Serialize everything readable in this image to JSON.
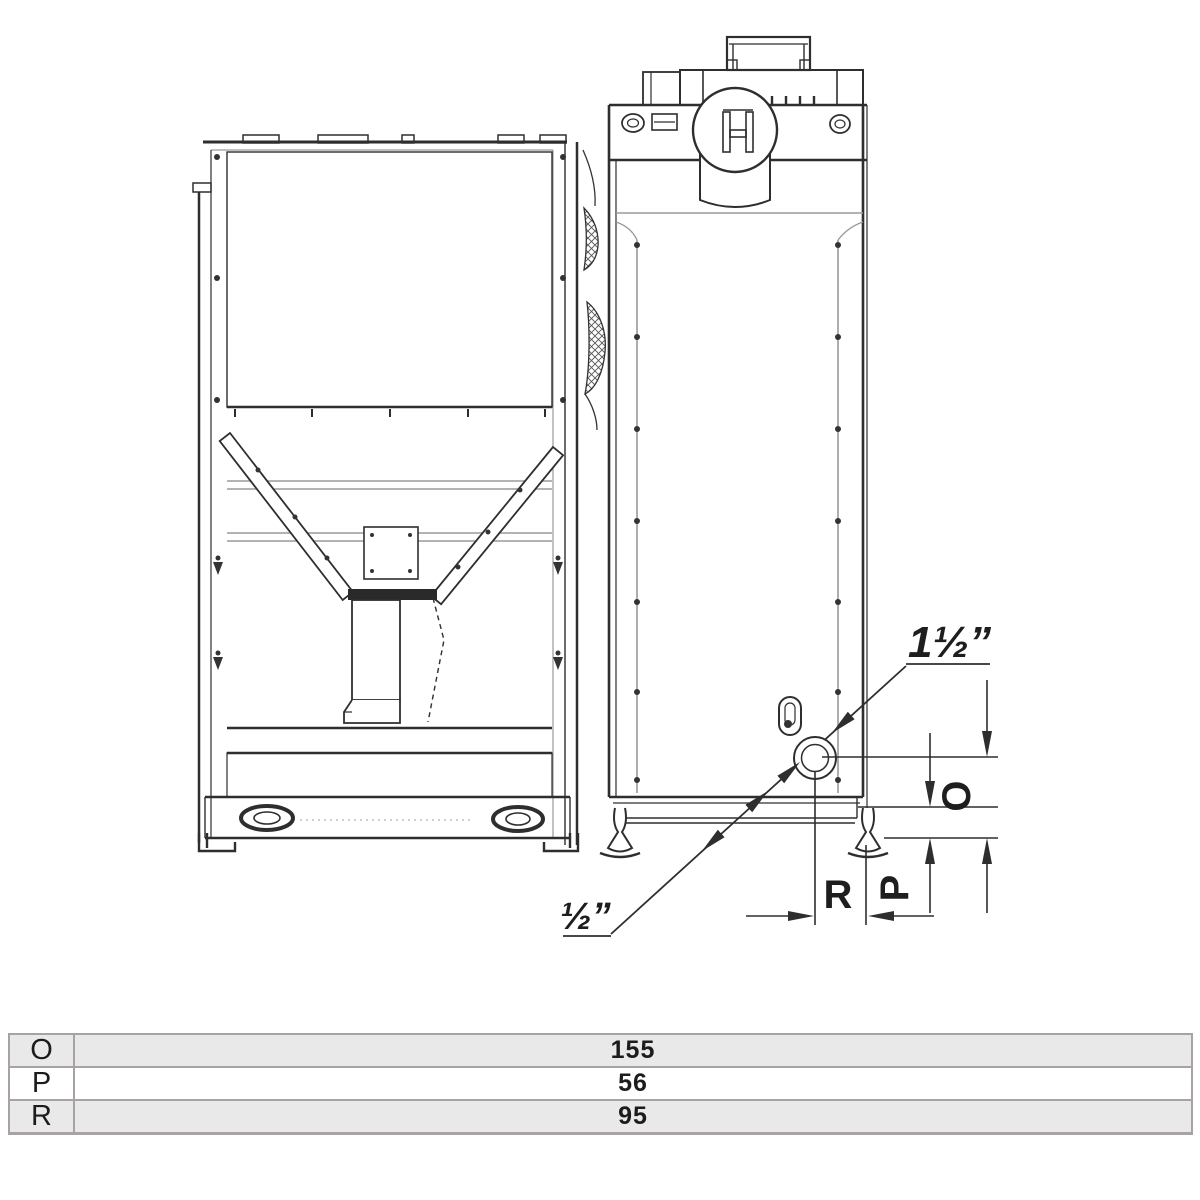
{
  "drawing": {
    "annotations": {
      "fitting_top_label": "1½”",
      "fitting_bottom_label": "½”",
      "dim_height_upper": "O",
      "dim_height_lower": "P",
      "dim_depth": "R"
    },
    "colors": {
      "line": "#2e2e2e",
      "panel_line": "#9a9a9a",
      "hatch": "#555555"
    }
  },
  "table": {
    "rows": [
      {
        "label": "O",
        "value": "155"
      },
      {
        "label": "P",
        "value": "56"
      },
      {
        "label": "R",
        "value": "95"
      }
    ],
    "border_color": "#a8a2a2",
    "alt_row_bg": "#e9e9e9"
  }
}
